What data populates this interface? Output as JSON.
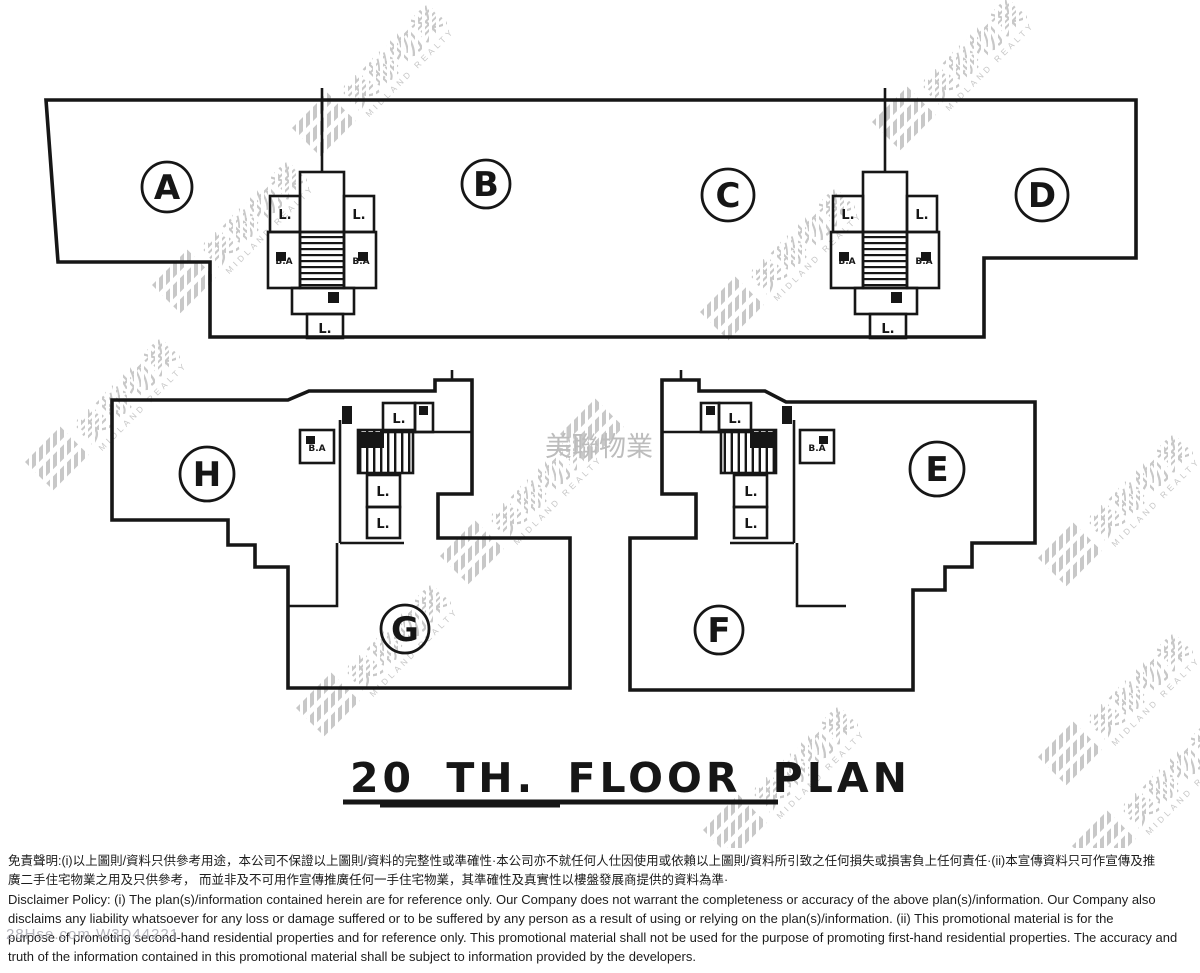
{
  "page": {
    "background": "#ffffff",
    "ink": "#161616",
    "watermark_color": "#c8c8c8"
  },
  "title": {
    "text": "20 TH. FLOOR PLAN"
  },
  "watermark": {
    "cjk": "美聯物業",
    "latin": "MIDLAND REALTY",
    "ref_code": "28Hse.com W3D44221"
  },
  "units": {
    "a": "A",
    "b": "B",
    "c": "C",
    "d": "D",
    "e": "E",
    "f": "F",
    "g": "G",
    "h": "H"
  },
  "room_labels": {
    "lift": "L.",
    "bath": "B.A"
  },
  "disclaimer": {
    "zh_line1": "免責聲明:(i)以上圖則/資料只供參考用途，本公司不保證以上圖則/資料的完整性或準確性·本公司亦不就任何人仕因使用或依賴以上圖則/資料所引致之任何損失或損害負上任何責任·(ii)本宣傳資料只可作宣傳及推",
    "zh_line2": "廣二手住宅物業之用及只供參考， 而並非及不可用作宣傳推廣任何一手住宅物業，其準確性及真實性以樓盤發展商提供的資料為準·",
    "en_line1": "Disclaimer Policy: (i) The plan(s)/information contained herein are for reference only. Our Company does not warrant the completeness or accuracy of the above plan(s)/information. Our Company also",
    "en_line2": "disclaims any liability whatsoever for any loss or damage suffered or to be suffered by any person as a result of using or relying on the plan(s)/information. (ii) This promotional material is for the",
    "en_line3": "purpose of promoting second-hand residential properties and for reference only. This promotional material shall not be used for the purpose of promoting first-hand residential properties. The accuracy and",
    "en_line4": "truth of the information contained in this promotional material shall be subject to information provided by the developers."
  }
}
